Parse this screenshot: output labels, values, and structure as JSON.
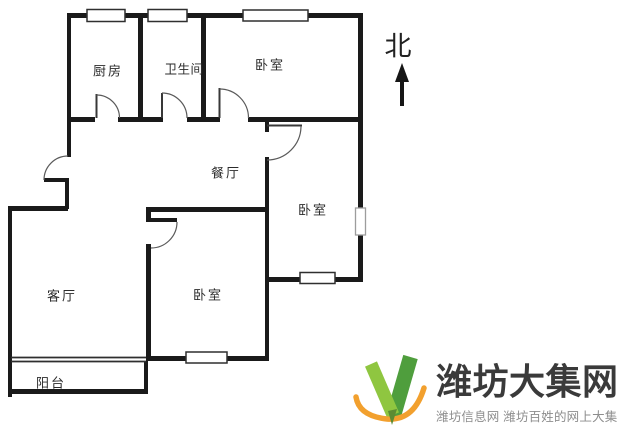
{
  "floorplan": {
    "rooms": [
      {
        "name": "kitchen",
        "label": "厨房"
      },
      {
        "name": "bathroom",
        "label": "卫生间"
      },
      {
        "name": "bedroom-north",
        "label": "卧室"
      },
      {
        "name": "dining-room",
        "label": "餐厅"
      },
      {
        "name": "bedroom-east",
        "label": "卧室"
      },
      {
        "name": "bedroom-south",
        "label": "卧室"
      },
      {
        "name": "living-room",
        "label": "客厅"
      },
      {
        "name": "balcony",
        "label": "阳台"
      }
    ],
    "compass": {
      "label": "北"
    },
    "ink_color": "#1a1a1a"
  },
  "watermark": {
    "title": "潍坊大集网",
    "subtitle": "潍坊信息网 潍坊百姓的网上大集",
    "colors": {
      "green_light": "#8fc640",
      "green_dark": "#4f9e3d",
      "tail_green": "#5c8b33",
      "orange": "#f2a02e",
      "title_text": "#3a3a3a",
      "subtitle_text": "#8d8d8d"
    }
  }
}
